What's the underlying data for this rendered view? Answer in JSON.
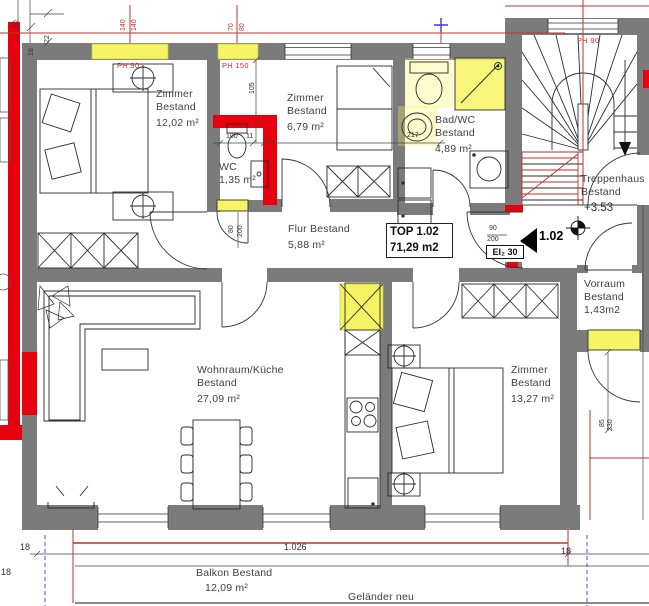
{
  "colors": {
    "wall_gray": "#7b7b7b",
    "new_red": "#e8000e",
    "highlight_yellow": "#f6f464",
    "dim_red": "#c2302c",
    "marker_blue": "#3a3ad0",
    "line_black": "#2b2b2b"
  },
  "rooms": {
    "zimmer1": {
      "name": "Zimmer",
      "type": "Bestand",
      "area": "12,02 m²"
    },
    "zimmer2": {
      "name": "Zimmer",
      "type": "Bestand",
      "area": "6,79 m²"
    },
    "wc": {
      "name": "WC",
      "area": "1,35 m²"
    },
    "bad": {
      "name": "Bad/WC",
      "type": "Bestand",
      "area": "4,89 m²"
    },
    "flur": {
      "name": "Flur Bestand",
      "area": "5,88 m²"
    },
    "treppenhaus": {
      "name": "Treppenhaus",
      "type": "Bestand",
      "level": "+3.53"
    },
    "vorraum": {
      "name": "Vorraum",
      "type": "Bestand",
      "area": "1,43m2"
    },
    "wohnraum": {
      "name": "Wohnraum/Küche",
      "type": "Bestand",
      "area": "27,09 m²"
    },
    "zimmer3": {
      "name": "Zimmer",
      "type": "Bestand",
      "area": "13,27 m²"
    },
    "balkon": {
      "name": "Balkon Bestand",
      "area": "12,09 m²"
    }
  },
  "unit": {
    "label": "TOP 1.02",
    "area": "71,29 m2",
    "number": "1.02",
    "door_class": "EI₂ 30"
  },
  "annotations": {
    "gelaender": "Geländer neu"
  },
  "dims": {
    "t140a": "140",
    "t140b": "140",
    "t70": "70",
    "t80": "80",
    "ph90_left": "PH 90",
    "ph150": "PH 150",
    "ph90_stairs": "PH 90",
    "c20": "20",
    "c22": "22",
    "c18": "18",
    "d105": "105",
    "d100": "100",
    "d11": "11",
    "d217": "217",
    "wc_w": "80",
    "wc_h": "200",
    "entry_w": "90",
    "entry_h": "200",
    "vd_w": "85",
    "vd_h": "230",
    "balkon_len": "1.026",
    "b18_left": "18",
    "b18_right": "18",
    "b18_side": "18"
  }
}
